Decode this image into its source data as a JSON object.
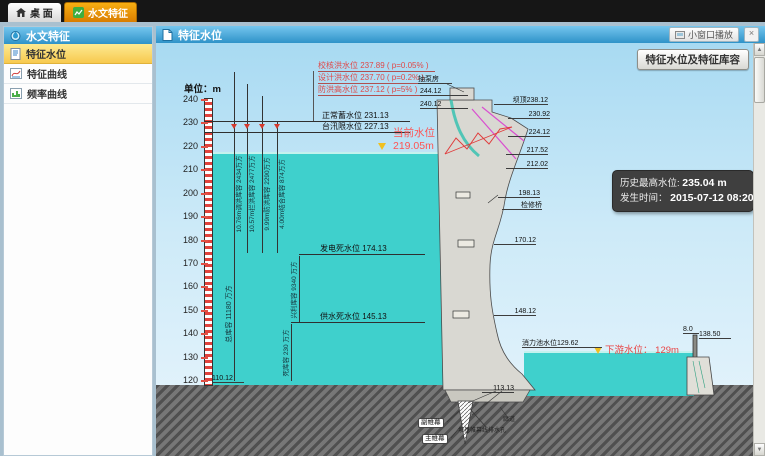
{
  "tabs": {
    "desktop": "桌 面",
    "active": "水文特征"
  },
  "sidebar": {
    "title": "水文特征",
    "items": [
      "特征水位",
      "特征曲线",
      "频率曲线"
    ]
  },
  "header": {
    "title": "特征水位",
    "mini_window": "小窗口播放",
    "close": "×"
  },
  "toolbar": {
    "capacity_button": "特征水位及特征库容"
  },
  "diagram": {
    "unit": "单位：m",
    "axis_ticks": [
      "240",
      "230",
      "220",
      "210",
      "200",
      "190",
      "180",
      "170",
      "160",
      "150",
      "140",
      "130",
      "120"
    ],
    "flood_levels": [
      "校核洪水位 237.89 ( p=0.05% )",
      "设计洪水位 237.70 ( p=0.2% )",
      "防洪高水位 237.12 ( p=5% )"
    ],
    "normal_level": "正常蓄水位  231.13",
    "flood_limit_level": "台汛限水位  227.13",
    "current_level": {
      "label": "当前水位",
      "value": "219.05m"
    },
    "capacities": [
      "10.76m调洪库容 2434万方",
      "10.57m拦洪库容 2477万方",
      "9.99m防洪库容 2290万方",
      "4.00m结合库容 874万方"
    ],
    "total_capacity": "总库容 11180 万方",
    "beneficial_capacity": "兴利库容 9340 万方",
    "dead_capacity": "死库容 230 万方",
    "power_dead_level": "发电死水位  174.13",
    "supply_dead_level": "供水死水位  145.13",
    "callouts": [
      "抽泵房",
      "244.12",
      "240.12",
      "坝顶238.12",
      "230.92",
      "224.12",
      "217.52",
      "212.02",
      "198.13",
      "检修桥",
      "170.12",
      "148.12",
      "113.13",
      "110.12",
      "消力池水位129.62",
      "8.0",
      "138.50"
    ],
    "downstream": {
      "label": "下游水位：",
      "value": "129m"
    },
    "curtain_labels": [
      "副帷幕",
      "主帷幕"
    ],
    "foundation_labels": [
      "廊道",
      "坝基帷幕线排水孔"
    ],
    "history": {
      "l1_label": "历史最高水位:",
      "l1_value": "235.04 m",
      "l2_label": "发生时间：",
      "l2_value": "2015-07-12 08:20"
    }
  },
  "colors": {
    "accent_orange": "#f0a500",
    "header_blue": "#3a9ad2",
    "water": "#3fd0cc",
    "current_red": "#ff5252",
    "flood_red": "#e04848",
    "tooltip_bg": "#3f3f3f",
    "selected_yellow": "#f8cf5a"
  }
}
